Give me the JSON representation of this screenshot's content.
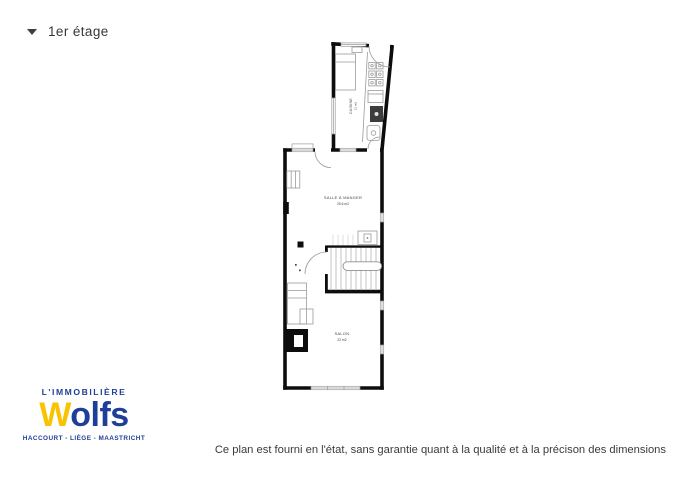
{
  "header": {
    "floor_label": "1er étage"
  },
  "floorplan": {
    "rooms": [
      {
        "name": "CUISINE",
        "area": "11 m2"
      },
      {
        "name": "SALLE À MANGER",
        "area": "25.6 m2"
      },
      {
        "name": "SALON",
        "area": "22 m2"
      }
    ]
  },
  "logo": {
    "tagline": "L'IMMOBILIÈRE",
    "brand_initial": "W",
    "brand_rest": "olfs",
    "cities": "HACCOURT - LIÈGE - MAASTRICHT"
  },
  "footer": {
    "disclaimer": "Ce plan est fourni en l'état, sans garantie quant à la qualité et à la précison des dimensions"
  },
  "colors": {
    "brand_blue": "#1e3f99",
    "brand_yellow": "#f8c300",
    "text_dark": "#3a3a3a",
    "wall_black": "#0d0d0d",
    "furniture_gray": "#9a9a9a"
  }
}
